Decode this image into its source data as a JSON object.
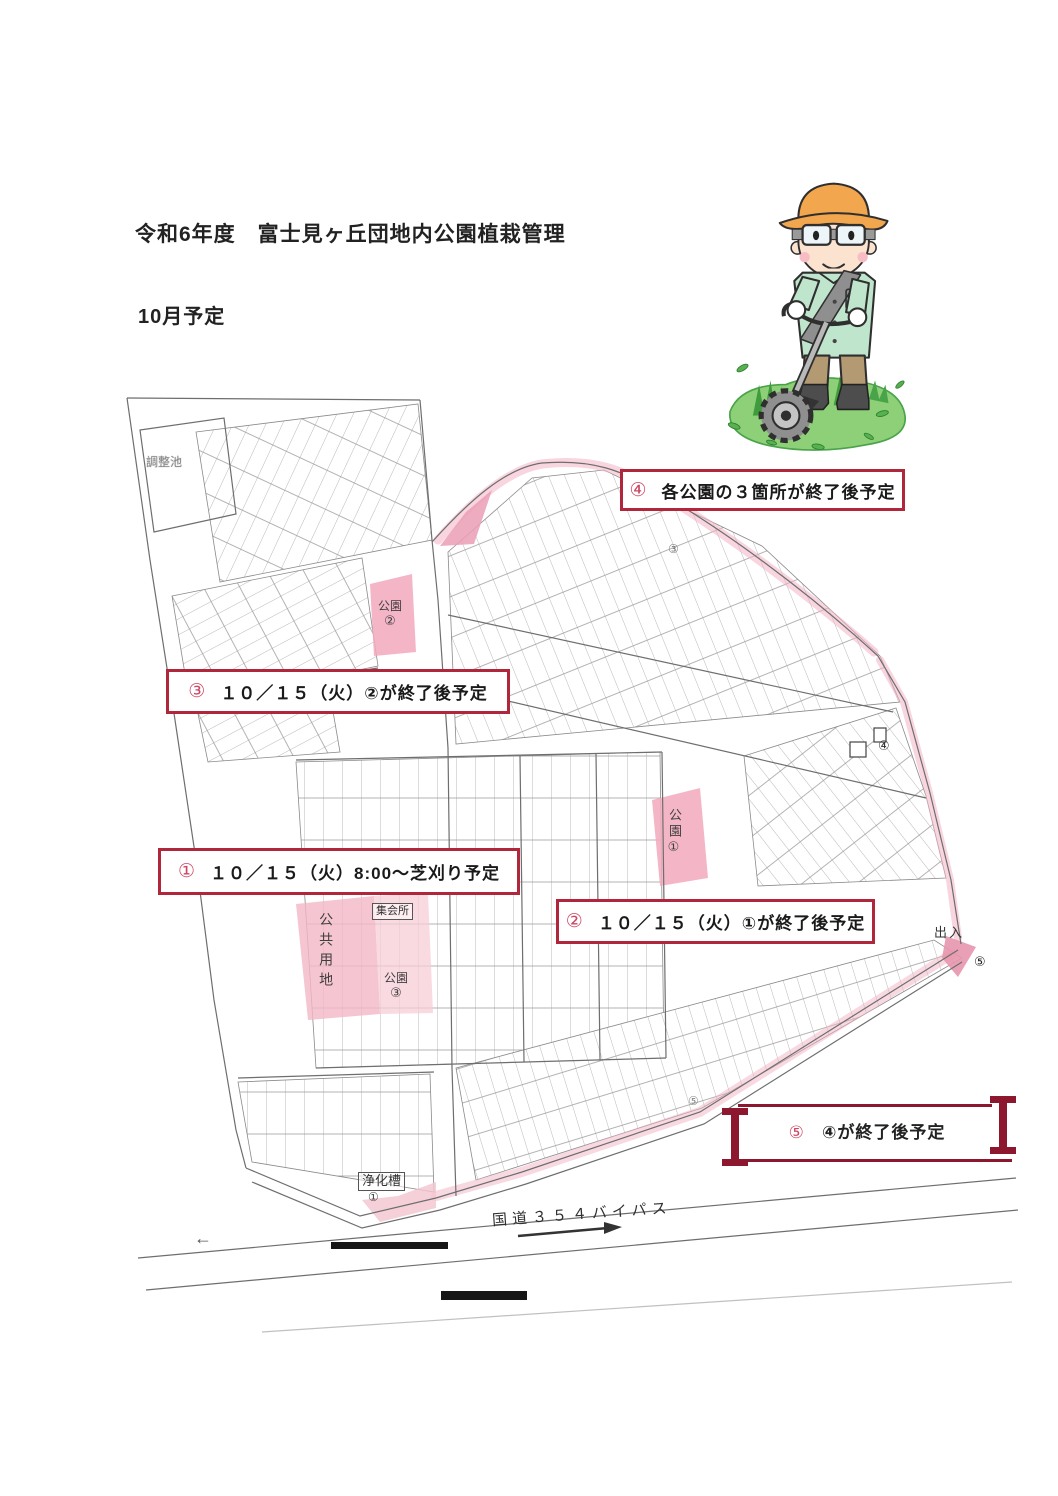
{
  "page": {
    "title": "令和6年度　富士見ヶ丘団地内公園植栽管理",
    "subtitle": "10月予定"
  },
  "annotations": {
    "a1": {
      "num": "①",
      "text": "１０／１５（火）8:00～芝刈り予定"
    },
    "a2": {
      "num": "②",
      "text": "１０／１５（火）①が終了後予定"
    },
    "a3": {
      "num": "③",
      "text": "１０／１５（火）②が終了後予定"
    },
    "a4": {
      "num": "④",
      "text": "各公園の３箇所が終了後予定"
    },
    "a5": {
      "num": "⑤",
      "text": "④が終了後予定"
    }
  },
  "map": {
    "labels": {
      "pond": "調整池",
      "park_top": {
        "name": "公園",
        "num": "②"
      },
      "park_east": {
        "name": "公園",
        "num": "①"
      },
      "park_center": {
        "name": "公園",
        "num": "③"
      },
      "public_land": "公共用地",
      "meeting_hall": "集会所",
      "septic_tank": {
        "name": "浄化槽",
        "num": "①"
      },
      "entrance": "出入",
      "route": "国道３５４バイパス",
      "west_arrow": "←"
    },
    "markers": {
      "top_road": "③",
      "east_edge": "④",
      "entrance_point": "⑤",
      "south_road": "⑤"
    }
  },
  "illustration": {
    "name": "worker-mowing-with-string-trimmer"
  },
  "colors": {
    "annotation_border": "#b0273c",
    "annotation_number": "#cc4763",
    "bracket_red": "#8e1730",
    "highlight_pink": "#f2b3c4",
    "map_line": "#6e6e6e"
  }
}
